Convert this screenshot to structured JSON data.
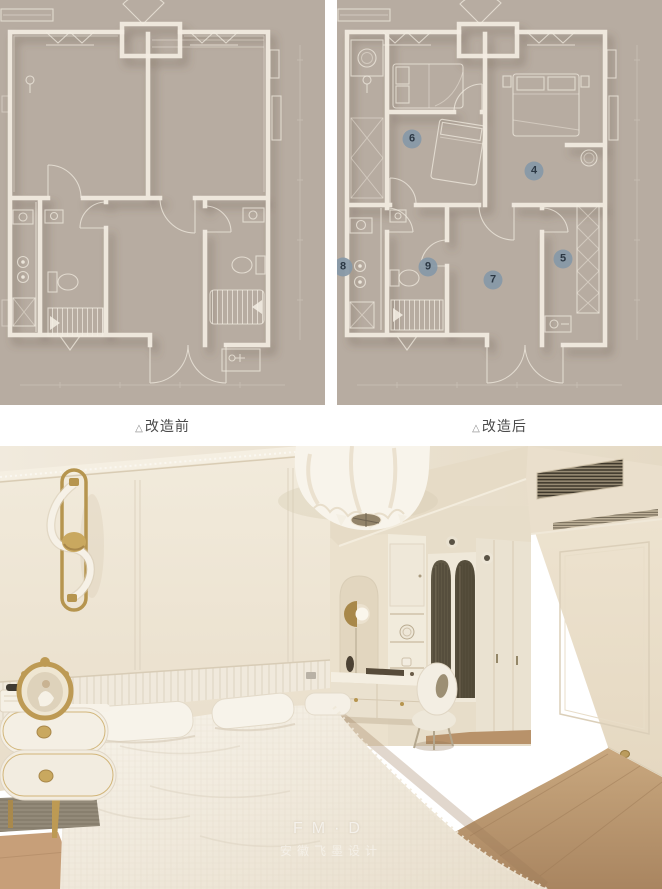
{
  "article": {
    "background": "#ffffff"
  },
  "figures": {
    "before": {
      "caption_marker": "△",
      "caption_label": "改造前"
    },
    "after": {
      "caption_marker": "△",
      "caption_label": "改造后",
      "markers": [
        {
          "label": "4",
          "x": 197,
          "y": 171
        },
        {
          "label": "5",
          "x": 226,
          "y": 259
        },
        {
          "label": "6",
          "x": 75,
          "y": 139
        },
        {
          "label": "7",
          "x": 156,
          "y": 280
        },
        {
          "label": "8",
          "x": 6,
          "y": 267
        },
        {
          "label": "9",
          "x": 91,
          "y": 267
        }
      ],
      "marker_style": {
        "bg": "#8799a8",
        "text": "#22303e"
      }
    },
    "plan_colors": {
      "background": "#b7aca1",
      "lines": "#f3ede2",
      "shadow": "#5f5142"
    }
  },
  "photo": {
    "watermark": {
      "line1": "FM·D",
      "line2": "安徽飞墨设计"
    },
    "palette": {
      "wall": "#ece4d4",
      "gold": "#b6954f",
      "floor": "#b8926a",
      "bedding": "#f4efe5"
    }
  }
}
